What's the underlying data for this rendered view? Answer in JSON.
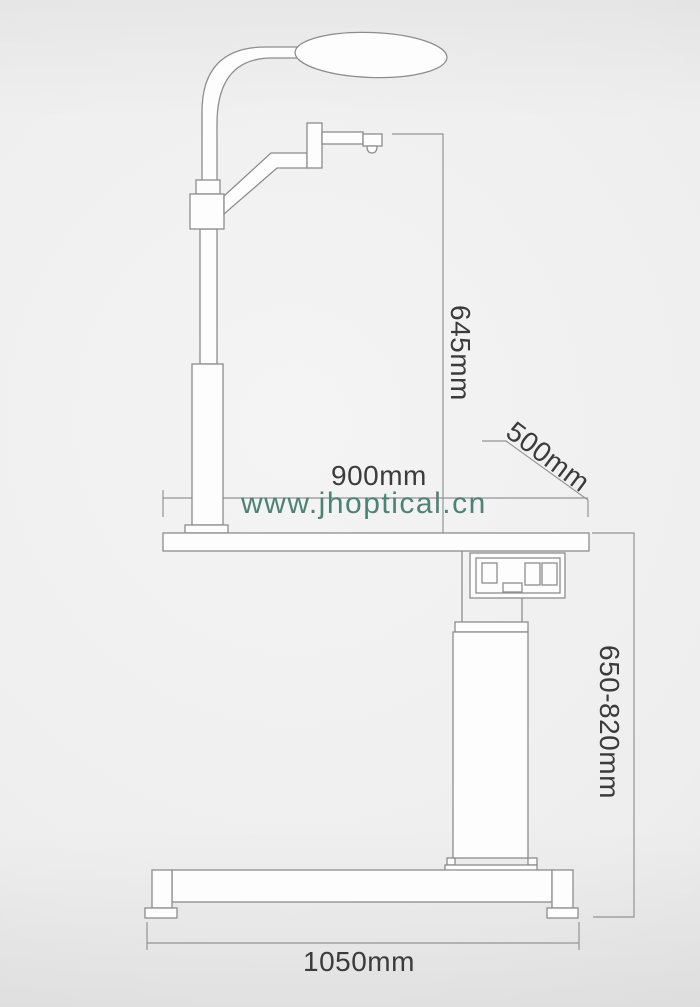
{
  "watermark": {
    "text": "www.jhoptical.cn"
  },
  "labels": {
    "rod_to_table_height": "645mm",
    "table_depth": "500mm",
    "table_width": "900mm",
    "column_height_range": "650-820mm",
    "base_width": "1050mm"
  },
  "colors": {
    "background": "#eeeeee",
    "line": "#8d8d8d",
    "dimension_line": "#949494",
    "text": "#3b3b3b",
    "watermark": "#4d8375",
    "shape_fill": "#fdfdfd"
  }
}
